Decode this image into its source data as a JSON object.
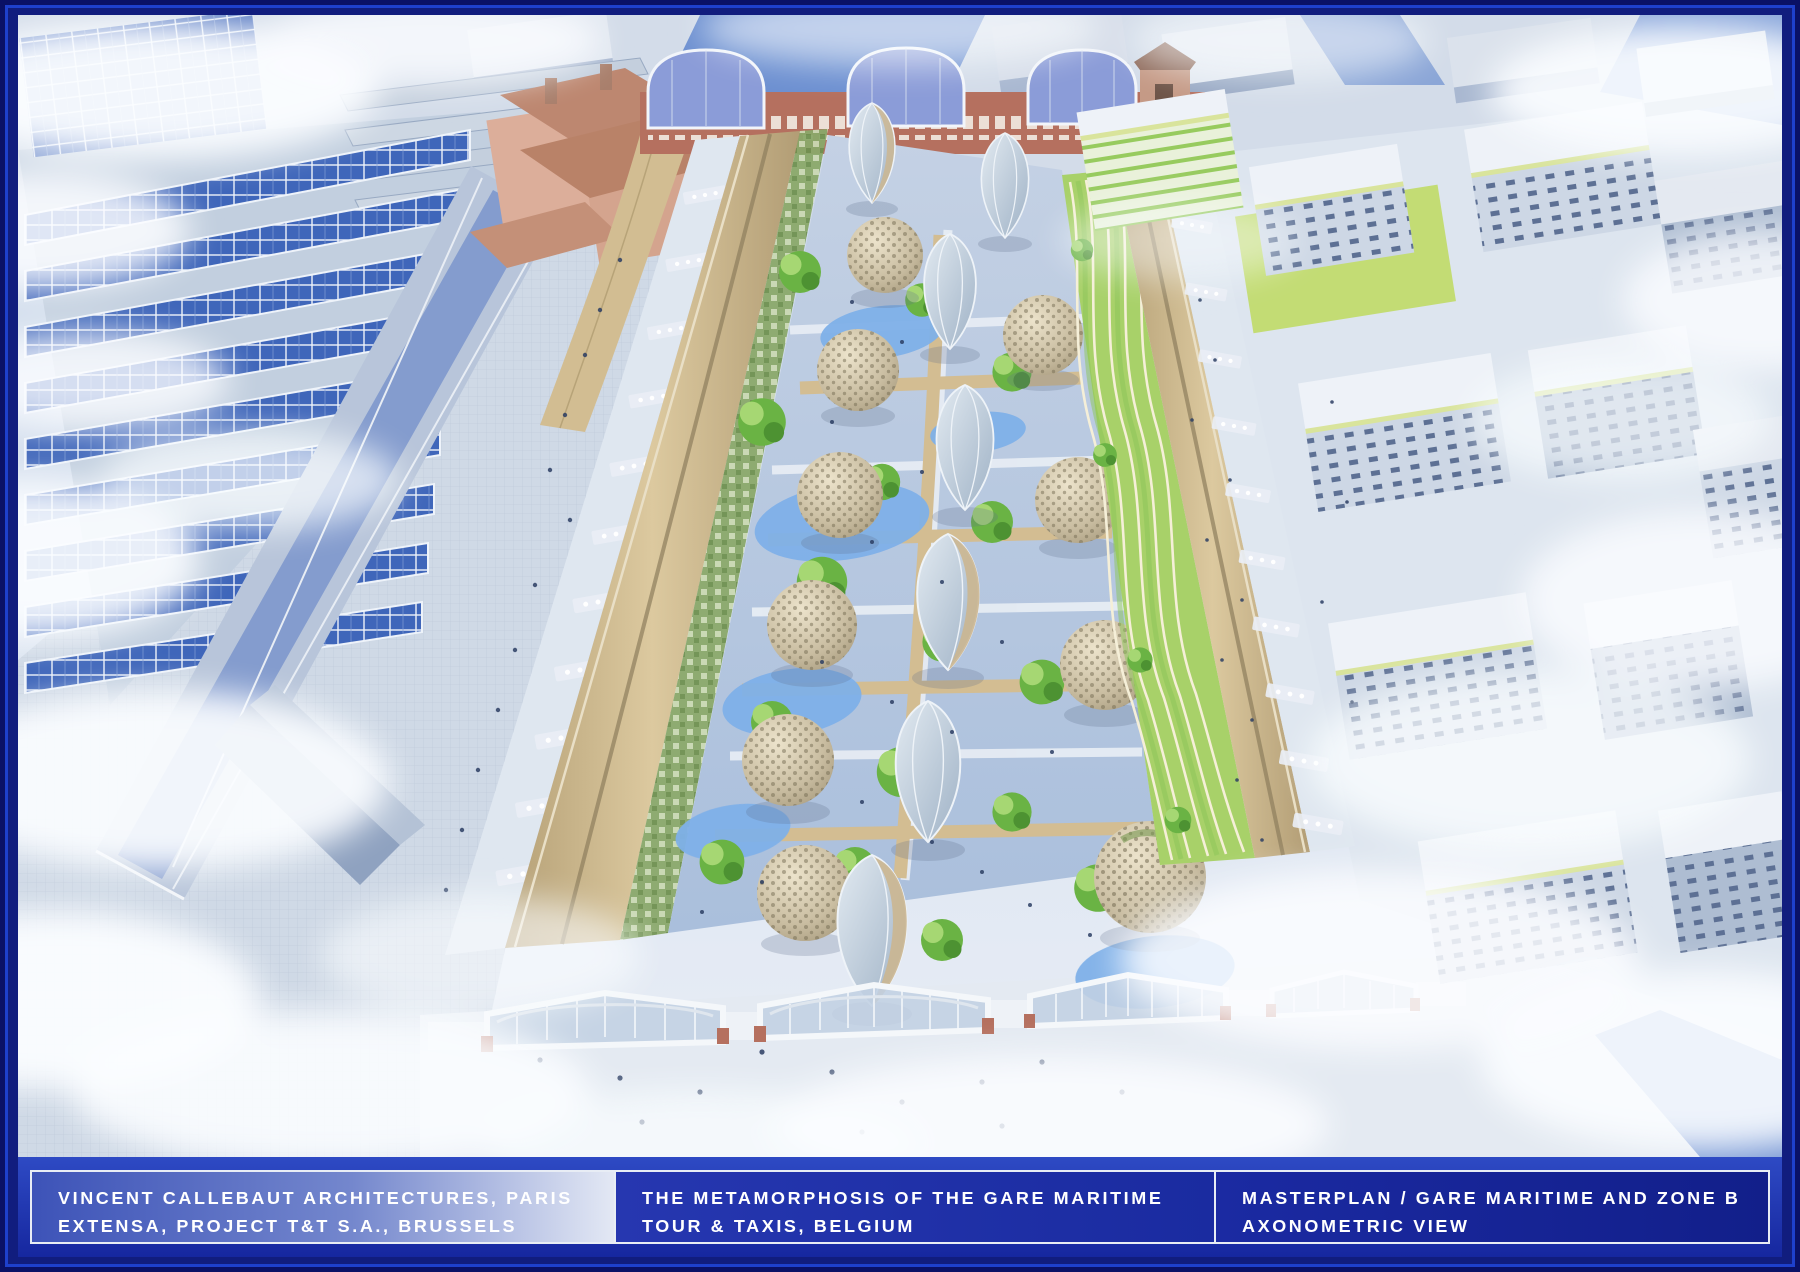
{
  "caption_bar": {
    "panels": [
      {
        "name": "credits",
        "line1": "VINCENT CALLEBAUT ARCHITECTURES, PARIS",
        "line2": "EXTENSA, PROJECT T&T S.A., BRUSSELS"
      },
      {
        "name": "project",
        "line1": "THE METAMORPHOSIS OF THE GARE MARITIME",
        "line2": "TOUR & TAXIS, BELGIUM"
      },
      {
        "name": "drawing",
        "line1": "MASTERPLAN / GARE MARITIME AND ZONE B",
        "line2": "AXONOMETRIC VIEW"
      }
    ]
  },
  "scene": {
    "type": "architectural-aerial-rendering",
    "description": "Aerial axonometric rendering of the Gare Maritime at Tour & Taxis, Brussels: three long halls with curved timber roofs enclose an interior urban garden of woven-timber dome pavilions and glass egg pavilions among trees, ponds and terraced vegetable waves; sawtooth solar greenhouses to the left, white Zone B housing blocks to the right, historic brick station facade with arched glass gables at top, glazed gable facades and public plaza at the bottom, soft clouds drifting over the city."
  },
  "palette": {
    "frame_outer": "#0a1166",
    "frame_stripe": "#1e40cc",
    "frame_inner": "#111d7e",
    "caption_bg_top": "#2e4ac4",
    "caption_bg_bot": "#16279f",
    "caption_border": "#e8edf5",
    "caption_text": "#ffffff",
    "sky_base": "#d3dfee",
    "cloud": "#fbfdff",
    "city_top": "#e2e8f1",
    "city_side": "#a9b8d1",
    "road_blue": "#5b82cc",
    "greenhouse_panel": "#3f66ba",
    "greenhouse_frame": "#eef3fa",
    "big_roof": "#b8c5da",
    "street": "#c6d0df",
    "historic_wall": "#dcae9a",
    "historic_roof": "#bd8770",
    "brick": "#b5705f",
    "arch_glass": "#8b9cd8",
    "hall_roof": "#cdb890",
    "hall_roof_dark": "#b29d75",
    "hall_roof_lite": "#e9dfc6",
    "terrace_green": "#a8d169",
    "terrace_line": "#f5efd8",
    "nave_paving": "#b9c8de",
    "path_tan": "#d3bd92",
    "water": "#7fb0e8",
    "tree_green": "#6ab344",
    "tree_light": "#a6d773",
    "tree_dark": "#4d9232",
    "dome_base": "#c9bda1",
    "dome_dark": "#746b52",
    "egg_glass": "#b7c5d3",
    "egg_rib": "#eef3f8",
    "plaza": "#e4eaf2",
    "people": "#2c3e63",
    "zoneb_top": "#eef2f8",
    "zoneb_front": "#cdd7e5",
    "zoneb_side": "#aebdd2",
    "zoneb_window": "#5d7094",
    "zoneb_roofline": "#d9e49c",
    "lawn": "#c3dc74",
    "green_facade": "#97cb5e"
  }
}
